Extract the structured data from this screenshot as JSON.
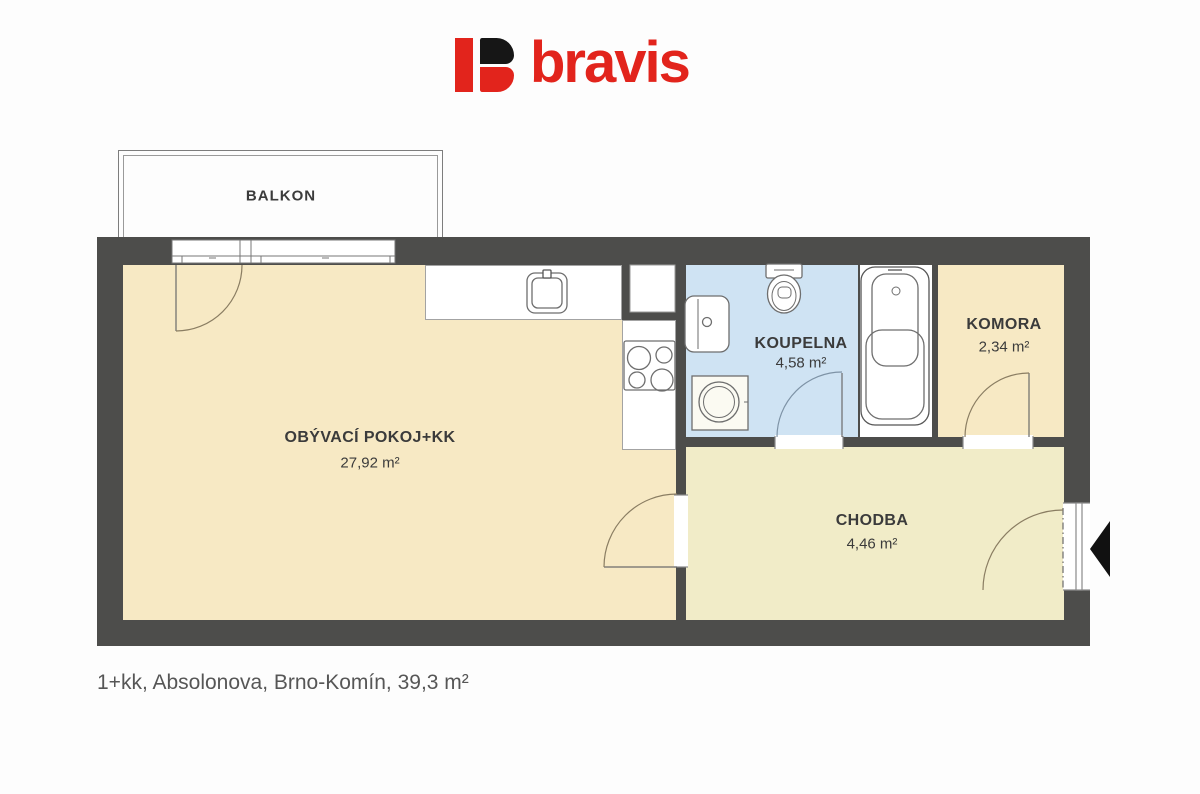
{
  "logo": {
    "text": "bravis",
    "brand_color": "#e2241c",
    "mark_colors": {
      "bar": "#e2241c",
      "b_top": "#161616",
      "b_bottom": "#e2241c"
    }
  },
  "plan": {
    "balcony": {
      "label": "BALKON"
    },
    "rooms": {
      "living": {
        "label": "OBÝVACÍ POKOJ+KK",
        "area": "27,92 m²"
      },
      "bathroom": {
        "label": "KOUPELNA",
        "area": "4,58 m²"
      },
      "storage": {
        "label": "KOMORA",
        "area": "2,34 m²"
      },
      "hallway": {
        "label": "CHODBA",
        "area": "4,46 m²"
      }
    },
    "fixtures": [
      "kitchen-sink",
      "stove",
      "toilet",
      "washbasin",
      "washing-machine",
      "bathtub",
      "entrance-arrow"
    ],
    "colors": {
      "wall": "#4d4d4b",
      "living_fill": "#f7e9c4",
      "hallway_fill": "#f1ecc8",
      "bathroom_fill": "#cfe3f3",
      "storage_fill": "#f7e9c4",
      "label_text": "#3b3b3b",
      "caption_text": "#565656"
    }
  },
  "caption": "1+kk, Absolonova, Brno-Komín, 39,3 m²"
}
